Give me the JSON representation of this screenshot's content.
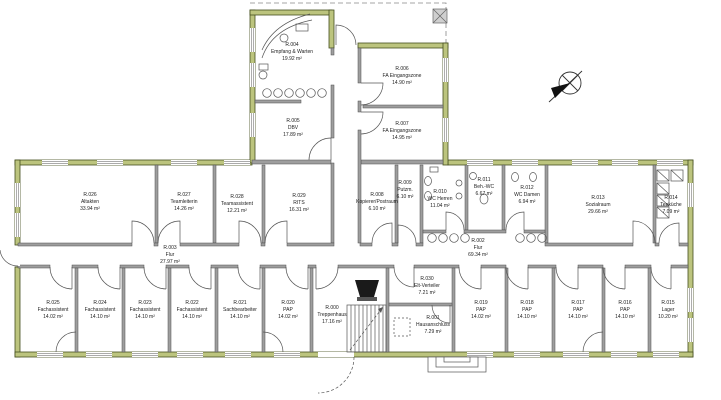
{
  "drawing": {
    "type": "architectural-floor-plan",
    "colors": {
      "exterior_wall_fill": "#bcc47e",
      "exterior_wall_edge": "#454f1f",
      "interior_wall_fill": "#9e9e9e",
      "interior_wall_edge": "#4f4f4f",
      "line": "#555555",
      "label_text": "#222222",
      "background": "#ffffff"
    }
  },
  "rooms": [
    {
      "id": "R.004",
      "name": "Empfang & Warten",
      "area": "19.92 m²"
    },
    {
      "id": "R.005",
      "name": "DBV",
      "area": "17.89 m²"
    },
    {
      "id": "R.006",
      "name": "FA Eingangszone",
      "area": "14.90 m²"
    },
    {
      "id": "R.007",
      "name": "FA Eingangszone",
      "area": "14.95 m²"
    },
    {
      "id": "R.026",
      "name": "Altakten",
      "area": "33.94 m²"
    },
    {
      "id": "R.027",
      "name": "Teamleiterin",
      "area": "14.26 m²"
    },
    {
      "id": "R.028",
      "name": "Teamassistent",
      "area": "12.21 m²"
    },
    {
      "id": "R.029",
      "name": "RITS",
      "area": "16.31 m²"
    },
    {
      "id": "R.008",
      "name": "Kopierer/Postraum",
      "area": "6.10 m²"
    },
    {
      "id": "R.009",
      "name": "Putzm.",
      "area": "6.10 m²"
    },
    {
      "id": "R.010",
      "name": "WC Herren",
      "area": "11.04 m²"
    },
    {
      "id": "R.011",
      "name": "Beh.-WC",
      "area": "6.67 m²"
    },
    {
      "id": "R.012",
      "name": "WC Damen",
      "area": "6.94 m²"
    },
    {
      "id": "R.013",
      "name": "Sozialraum",
      "area": "29.66 m²"
    },
    {
      "id": "R.014",
      "name": "Teeküche",
      "area": "7.09 m²"
    },
    {
      "id": "R.003",
      "name": "Flur",
      "area": "27.97 m²"
    },
    {
      "id": "R.002",
      "name": "Flur",
      "area": "69.34 m²"
    },
    {
      "id": "R.000",
      "name": "Treppenhaus",
      "area": "17.16 m²"
    },
    {
      "id": "R.030",
      "name": "Elt-Verteiler",
      "area": "7.21 m²"
    },
    {
      "id": "R.001",
      "name": "Hausanschluss",
      "area": "7.29 m²"
    },
    {
      "id": "R.025",
      "name": "Fachassistent",
      "area": "14.02 m²"
    },
    {
      "id": "R.024",
      "name": "Fachassistent",
      "area": "14.10 m²"
    },
    {
      "id": "R.023",
      "name": "Fachassistent",
      "area": "14.10 m²"
    },
    {
      "id": "R.022",
      "name": "Fachassistent",
      "area": "14.10 m²"
    },
    {
      "id": "R.021",
      "name": "Sachbearbeiter",
      "area": "14.10 m²"
    },
    {
      "id": "R.020",
      "name": "PAP",
      "area": "14.02 m²"
    },
    {
      "id": "R.019",
      "name": "PAP",
      "area": "14.02 m²"
    },
    {
      "id": "R.018",
      "name": "PAP",
      "area": "14.10 m²"
    },
    {
      "id": "R.017",
      "name": "PAP",
      "area": "14.10 m²"
    },
    {
      "id": "R.016",
      "name": "PAP",
      "area": "14.10 m²"
    },
    {
      "id": "R.015",
      "name": "Lager",
      "area": "10.20 m²"
    }
  ]
}
